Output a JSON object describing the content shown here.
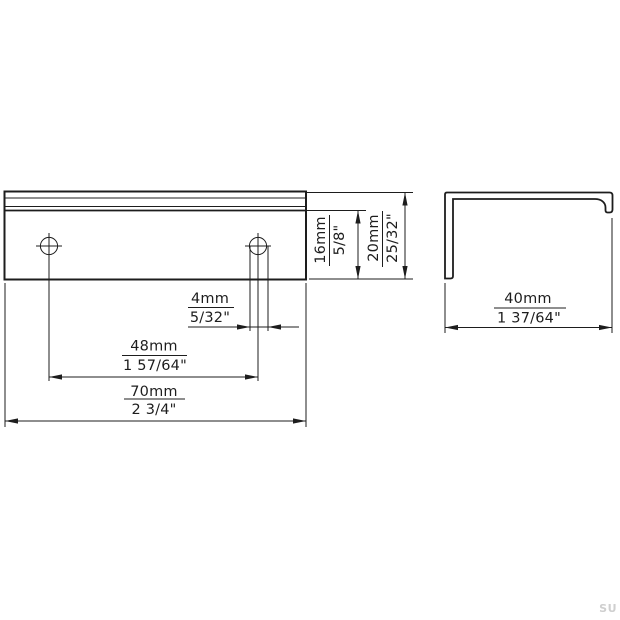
{
  "dims": {
    "hole_diameter": {
      "mm": "4mm",
      "inch": "5/32\""
    },
    "hole_spacing": {
      "mm": "48mm",
      "inch": "1 57/64\""
    },
    "width": {
      "mm": "70mm",
      "inch": "2 3/4\""
    },
    "face_height": {
      "mm": "16mm",
      "inch": "5/8\""
    },
    "total_height": {
      "mm": "20mm",
      "inch": "25/32\""
    },
    "depth": {
      "mm": "40mm",
      "inch": "1 37/64\""
    }
  },
  "watermark": "SU",
  "colors": {
    "line": "#1d1d1d",
    "background": "#ffffff",
    "watermark": "#cfcfcf"
  }
}
